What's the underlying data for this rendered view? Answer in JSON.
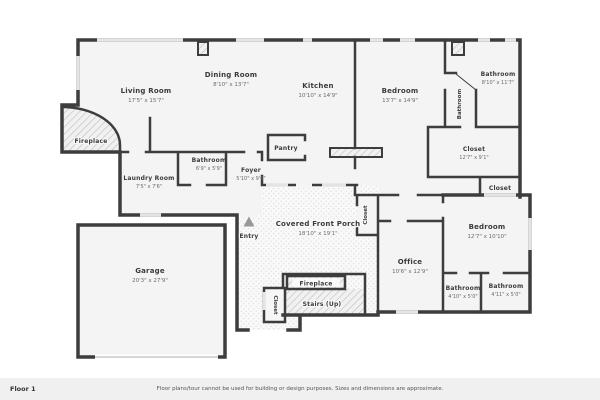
{
  "colors": {
    "wall": "#3d3d3d",
    "room_fill": "#f4f4f4",
    "window": "#e4e4e4",
    "porch_dot": "#dedede",
    "hatch_line": "#b9b9b9"
  },
  "rooms": {
    "living": {
      "name": "Living Room",
      "dims": "17'5\" x 15'7\""
    },
    "dining": {
      "name": "Dining Room",
      "dims": "8'10\" x 13'7\""
    },
    "kitchen": {
      "name": "Kitchen",
      "dims": "10'10\" x 14'9\""
    },
    "bedroom_top": {
      "name": "Bedroom",
      "dims": "13'7\" x 14'9\""
    },
    "bathroom_top": {
      "name": "Bathroom",
      "dims": "8'10\" x 11'7\""
    },
    "bathroom_top_small": {
      "name": "Bathroom"
    },
    "closet_large": {
      "name": "Closet",
      "dims": "12'7\" x 9'1\""
    },
    "closet_small": {
      "name": "Closet"
    },
    "bedroom_right": {
      "name": "Bedroom",
      "dims": "12'7\" x 10'10\""
    },
    "office": {
      "name": "Office",
      "dims": "10'6\" x 12'9\""
    },
    "bathroom_bl": {
      "name": "Bathroom",
      "dims": "4'10\" x 5'0\""
    },
    "bathroom_br": {
      "name": "Bathroom",
      "dims": "4'11\" x 5'0\""
    },
    "bathroom_mid": {
      "name": "Bathroom",
      "dims": "6'9\" x 5'9\""
    },
    "laundry": {
      "name": "Laundry Room",
      "dims": "7'5\" x 7'6\""
    },
    "foyer": {
      "name": "Foyer",
      "dims": "5'10\" x 9'6\""
    },
    "pantry": {
      "name": "Pantry"
    },
    "porch": {
      "name": "Covered Front Porch",
      "dims": "18'10\" x 19'1\""
    },
    "garage": {
      "name": "Garage",
      "dims": "20'3\" x 27'9\""
    },
    "entry": {
      "name": "Entry"
    },
    "fireplace_left": {
      "name": "Fireplace"
    },
    "fireplace_bottom": {
      "name": "Fireplace"
    },
    "stairs": {
      "name": "Stairs (Up)"
    },
    "closet_porch": {
      "name": "Closet"
    },
    "closet_stairs": {
      "name": "Closet"
    }
  },
  "footer": {
    "floor_label": "Floor 1",
    "disclaimer": "Floor plans/tour cannot be used for building or design purposes. Sizes and dimensions are approximate."
  }
}
